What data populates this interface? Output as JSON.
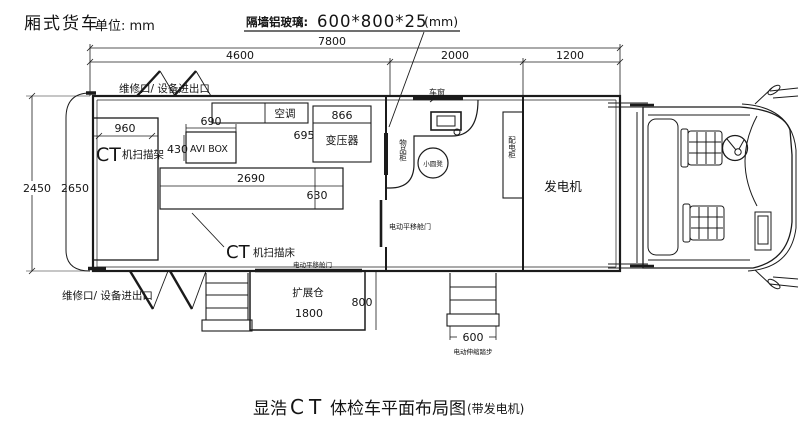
{
  "header": {
    "vehicle_type": "厢式货车",
    "unit": "单位: mm",
    "glass_label": "隔墙铝玻璃:",
    "glass_value": "600*800*25",
    "glass_unit": "(mm)"
  },
  "dimensions": {
    "total_length": "7800",
    "scan_room_length": "4600",
    "operator_room_length": "2000",
    "generator_room_length": "1200",
    "body_width": "2450",
    "inner_width": "2650",
    "scanner_frame_width": "960",
    "avi_box_width": "690",
    "avi_box_depth": "430",
    "transformer_width": "866",
    "transformer_depth": "695",
    "bed_length": "2690",
    "bed_width": "630",
    "expansion_length": "1800",
    "expansion_depth": "800",
    "steps_width": "600"
  },
  "labels": {
    "ct_frame_prefix": "CT",
    "ct_frame_name": "机扫描架",
    "ct_bed_prefix": "CT",
    "ct_bed_name": "机扫描床",
    "avi_box": "AVI BOX",
    "air_conditioner": "空调",
    "transformer": "变压器",
    "generator": "发电机",
    "storage_cabinet": "物品柜",
    "power_cabinet": "配电柜",
    "stool": "小圆凳",
    "expansion_bay": "扩展仓",
    "vehicle_window": "车窗",
    "service_door_top": "维修口/ 设备进出口",
    "service_door_bottom": "维修口/ 设备进出口",
    "sliding_door_side": "电动平移舱门",
    "sliding_door_bottom": "电动平移舱门",
    "telescopic_steps": "电动伸缩踏步"
  },
  "caption": {
    "part1": "显浩",
    "part2": "CT",
    "part3": "体检车平面布局图",
    "part4": "(带发电机)"
  },
  "colors": {
    "line": "#1b1b1b",
    "background": "#ffffff"
  }
}
